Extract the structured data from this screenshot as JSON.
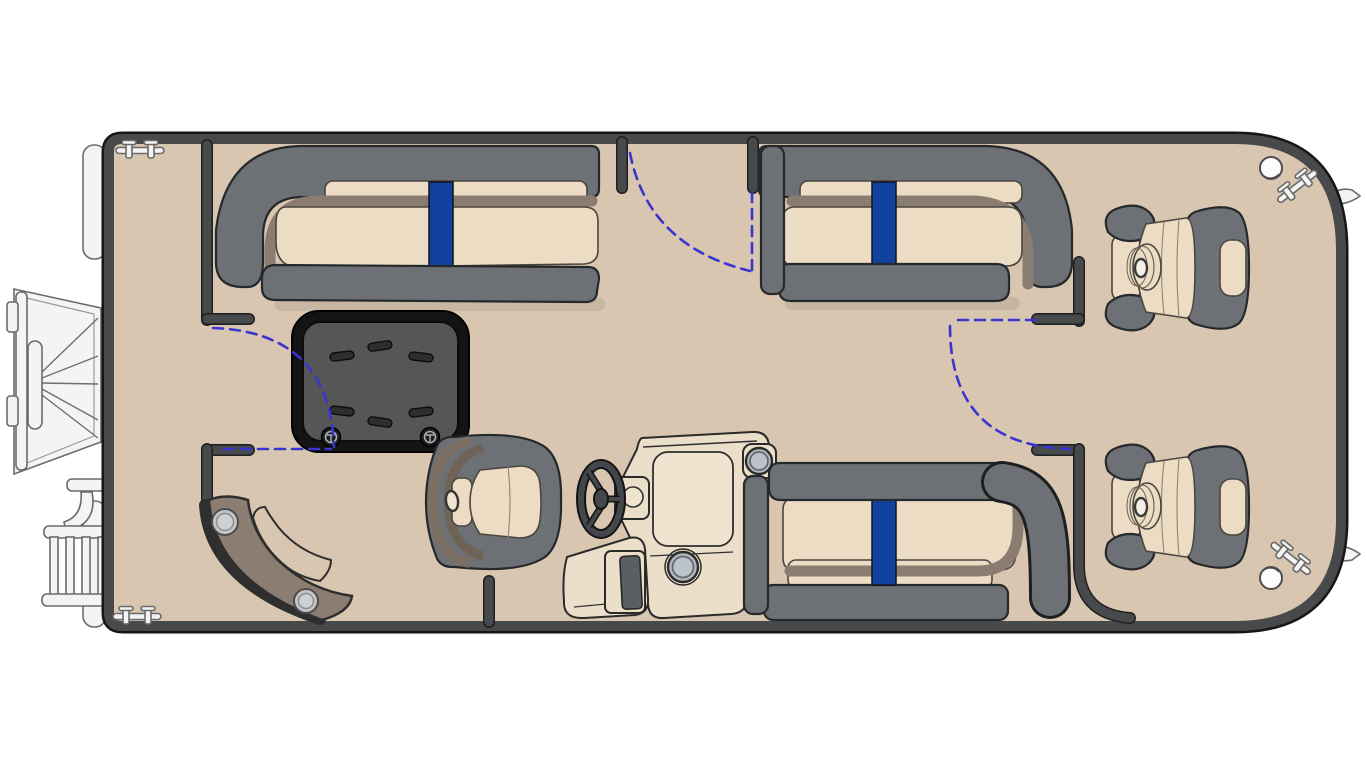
{
  "diagram": {
    "type": "pontoon-boat-floor-plan",
    "view": "top-down",
    "bow_side": "right",
    "stern_side": "left",
    "colors": {
      "background": "#ffffff",
      "deck": "#d8c6b0",
      "deck_shade": "#cdbaa4",
      "hull_rail": "#47494b",
      "outline": "#161616",
      "seat_gray": "#6d7175",
      "cushion_tan": "#eddcc4",
      "cushion_trim": "#8a7c70",
      "accent_blue": "#10419f",
      "swing_blue": "#3b35d0",
      "table_top": "#565656",
      "table_edge": "#141414",
      "console_cream": "#ecdfca",
      "console_panel": "#f0e4d1",
      "speaker_gray": "#b0b8bf",
      "fitting_white": "#f4f4f4",
      "fitting_stroke": "#6a6a6a",
      "step_brown": "#8b7d71"
    },
    "components": [
      "hull-deck",
      "port-stern-fence",
      "starboard-cross-fence",
      "bow-gate",
      "port-side-gate",
      "aft-crossover-gate",
      "gate-swing-arcs",
      "port-bow-lounge",
      "starboard-bow-lounge",
      "aft-lounge",
      "blue-accent-stripes",
      "removable-cocktail-table",
      "table-cup-holders",
      "stern-corner-step",
      "step-speakers",
      "helm-console",
      "console-speakers",
      "windshield",
      "steering-wheel",
      "helm-chair",
      "bow-fishing-chair-upper",
      "bow-fishing-chair-lower",
      "outboard-motor",
      "boarding-ladder",
      "pontoon-tube-stern-caps",
      "pontoon-nose-cones",
      "mooring-cleats",
      "navigation-lights"
    ]
  }
}
